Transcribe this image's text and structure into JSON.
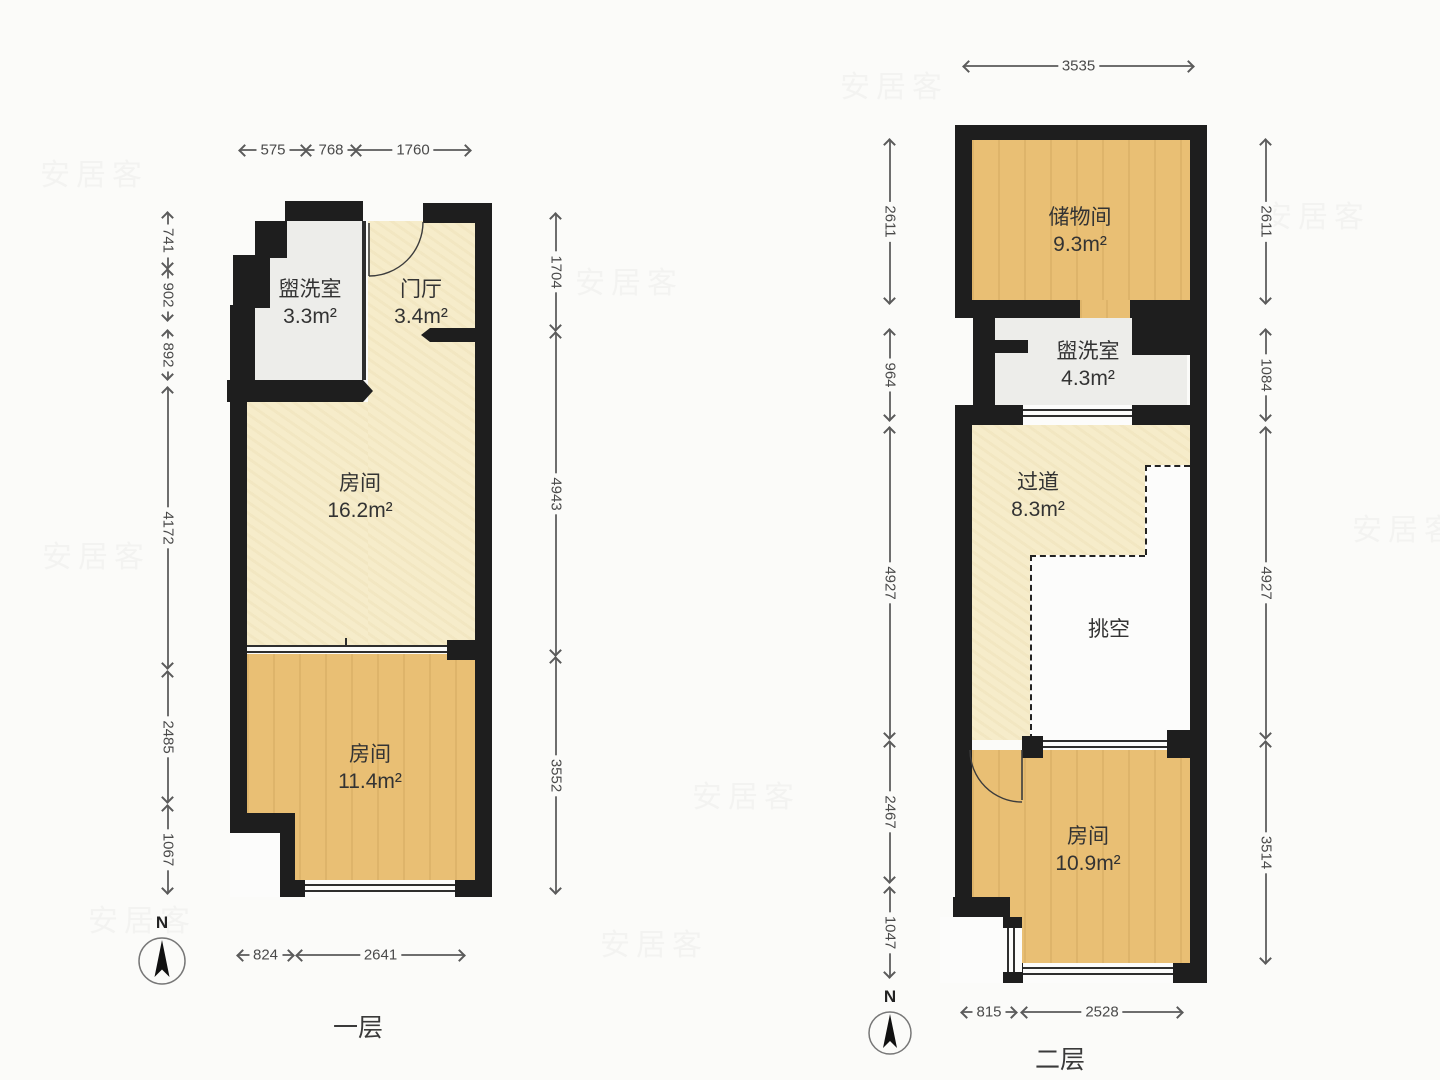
{
  "watermark": "安居客",
  "watermarks": [
    {
      "x": 40,
      "y": 150
    },
    {
      "x": 840,
      "y": 62
    },
    {
      "x": 575,
      "y": 258
    },
    {
      "x": 1262,
      "y": 192
    },
    {
      "x": 42,
      "y": 532
    },
    {
      "x": 692,
      "y": 772
    },
    {
      "x": 1352,
      "y": 505
    },
    {
      "x": 88,
      "y": 896
    },
    {
      "x": 600,
      "y": 920
    }
  ],
  "colors": {
    "wall": "#1e1e1e",
    "cream": "#f6ecca",
    "wood": "#e9bf74",
    "gray": "#ededea",
    "background": "#fbfbf9"
  },
  "plans": [
    {
      "title": "一层",
      "compass_label": "N",
      "rooms": [
        {
          "name": "盥洗室",
          "area": "3.3m²",
          "x": 310,
          "y": 276
        },
        {
          "name": "门厅",
          "area": "3.4m²",
          "x": 421,
          "y": 276
        },
        {
          "name": "房间",
          "area": "16.2m²",
          "x": 360,
          "y": 470
        },
        {
          "name": "房间",
          "area": "11.4m²",
          "x": 370,
          "y": 741
        }
      ],
      "dims": [
        {
          "value": "575",
          "orient": "h",
          "x": 240,
          "y": 150,
          "len": 66
        },
        {
          "value": "768",
          "orient": "h",
          "x": 306,
          "y": 150,
          "len": 50
        },
        {
          "value": "1760",
          "orient": "h",
          "x": 356,
          "y": 150,
          "len": 114
        },
        {
          "value": "741",
          "orient": "v",
          "x": 168,
          "y": 213,
          "len": 55
        },
        {
          "value": "902",
          "orient": "v",
          "x": 168,
          "y": 270,
          "len": 50
        },
        {
          "value": "892",
          "orient": "v",
          "x": 168,
          "y": 331,
          "len": 48
        },
        {
          "value": "4172",
          "orient": "v",
          "x": 168,
          "y": 388,
          "len": 280
        },
        {
          "value": "2485",
          "orient": "v",
          "x": 168,
          "y": 672,
          "len": 130
        },
        {
          "value": "1067",
          "orient": "v",
          "x": 168,
          "y": 806,
          "len": 87
        },
        {
          "value": "1704",
          "orient": "v",
          "x": 556,
          "y": 214,
          "len": 116
        },
        {
          "value": "4943",
          "orient": "v",
          "x": 556,
          "y": 333,
          "len": 322
        },
        {
          "value": "3552",
          "orient": "v",
          "x": 556,
          "y": 658,
          "len": 235
        },
        {
          "value": "824",
          "orient": "h",
          "x": 238,
          "y": 955,
          "len": 55
        },
        {
          "value": "2641",
          "orient": "h",
          "x": 297,
          "y": 955,
          "len": 167
        }
      ]
    },
    {
      "title": "二层",
      "compass_label": "N",
      "rooms": [
        {
          "name": "储物间",
          "area": "9.3m²",
          "x": 1080,
          "y": 204
        },
        {
          "name": "盥洗室",
          "area": "4.3m²",
          "x": 1088,
          "y": 338
        },
        {
          "name": "过道",
          "area": "8.3m²",
          "x": 1038,
          "y": 469
        },
        {
          "name": "挑空",
          "area": "",
          "x": 1109,
          "y": 616
        },
        {
          "name": "房间",
          "area": "10.9m²",
          "x": 1088,
          "y": 823
        }
      ],
      "dims": [
        {
          "value": "3535",
          "orient": "h",
          "x": 964,
          "y": 66,
          "len": 229
        },
        {
          "value": "2611",
          "orient": "v",
          "x": 890,
          "y": 140,
          "len": 163
        },
        {
          "value": "964",
          "orient": "v",
          "x": 890,
          "y": 330,
          "len": 90
        },
        {
          "value": "4927",
          "orient": "v",
          "x": 890,
          "y": 428,
          "len": 310
        },
        {
          "value": "2467",
          "orient": "v",
          "x": 890,
          "y": 742,
          "len": 140
        },
        {
          "value": "1047",
          "orient": "v",
          "x": 890,
          "y": 888,
          "len": 89
        },
        {
          "value": "2611",
          "orient": "v",
          "x": 1266,
          "y": 140,
          "len": 163
        },
        {
          "value": "1084",
          "orient": "v",
          "x": 1266,
          "y": 330,
          "len": 90
        },
        {
          "value": "4927",
          "orient": "v",
          "x": 1266,
          "y": 428,
          "len": 310
        },
        {
          "value": "3514",
          "orient": "v",
          "x": 1266,
          "y": 742,
          "len": 221
        },
        {
          "value": "815",
          "orient": "h",
          "x": 962,
          "y": 1012,
          "len": 54
        },
        {
          "value": "2528",
          "orient": "h",
          "x": 1022,
          "y": 1012,
          "len": 160
        }
      ]
    }
  ]
}
